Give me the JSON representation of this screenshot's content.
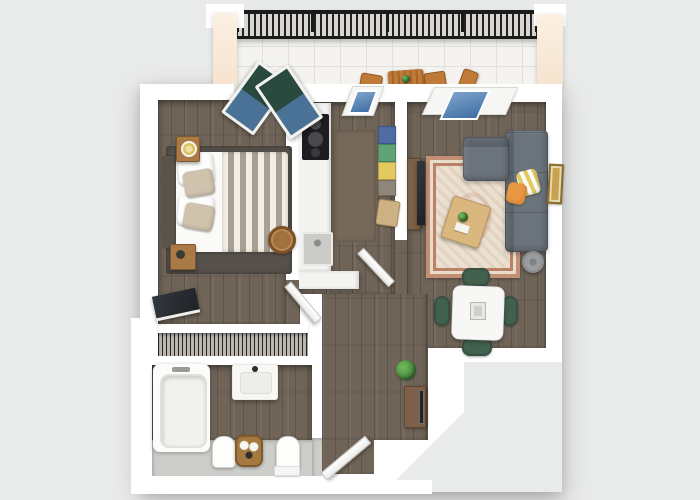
{
  "scene": {
    "description": "3D top-down render of a one-bedroom apartment floor plan with balcony",
    "view": "top-down 3D dollhouse",
    "background_color": "#e9eaea"
  },
  "palette": {
    "bg": "#e9eaea",
    "wall": "#ffffff",
    "wood": "#6f6457",
    "tile": "#f4f3ef",
    "gray_tile": "#cdcdca",
    "peach": "#f6e3cf",
    "railing_dark": "#1a1a1a",
    "sofa": "#6b737d",
    "rug_base": "#ebe0d0",
    "table_wood": "#d9b77f",
    "dining_chair": "#42604e",
    "cooktop": "#1d1d1f",
    "accent_orange": "#e8963f",
    "accent_yellow": "#e3c95f",
    "box_blue": "#4d6da3",
    "box_green": "#5fa377",
    "box_gray": "#8f867a",
    "glass_blue": "#3f6ea3",
    "door_green": "#2a4a40",
    "nightstand": "#a97a45",
    "headboard": "#5a544c",
    "pillow_beige": "#cfc3ae",
    "console": "#7c6148",
    "plant_green": "#3d7d34",
    "lamp_gray": "#8b8e90",
    "basket": "#a4793f",
    "art_gold": "#c9a24f"
  },
  "rooms": [
    {
      "id": "balcony",
      "name": "Balcony",
      "items": [
        "metal railing",
        "outdoor slat table with plant",
        "outdoor chairs"
      ]
    },
    {
      "id": "bedroom",
      "name": "Bedroom",
      "items": [
        "double bed with striped duvet",
        "headboard",
        "two wooden nightstands",
        "bedside lamp",
        "area rug",
        "round storage basket",
        "tv on stand",
        "wardrobe closet",
        "french doors to balcony"
      ]
    },
    {
      "id": "kitchen",
      "name": "Kitchen",
      "items": [
        "counter with cooktop",
        "sink",
        "runner rug",
        "shelf with colored storage boxes",
        "stool",
        "window"
      ]
    },
    {
      "id": "living_room",
      "name": "Living room",
      "items": [
        "l-shaped sectional sofa",
        "orange pillow",
        "yellow striped pillow",
        "persian rug",
        "coffee table with plant",
        "tv with media console",
        "wall art",
        "floor lamp",
        "window"
      ]
    },
    {
      "id": "dining_area",
      "name": "Dining area",
      "items": [
        "square white dining table",
        "four green chairs",
        "centerpiece"
      ]
    },
    {
      "id": "hallway",
      "name": "Hallway",
      "items": [
        "potted plant",
        "entry console with mirror",
        "entry door"
      ]
    },
    {
      "id": "bathroom",
      "name": "Bathroom",
      "items": [
        "bathtub",
        "vanity sink",
        "toilet",
        "bidet",
        "wicker towel basket",
        "bath mat"
      ]
    }
  ]
}
